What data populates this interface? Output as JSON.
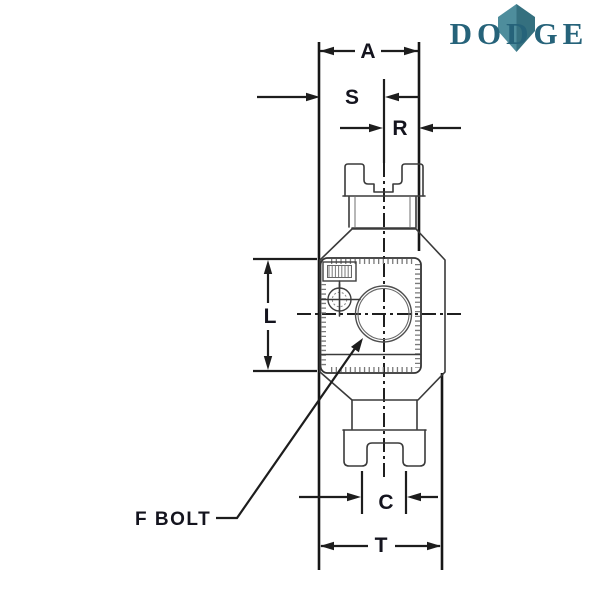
{
  "logo": {
    "text": "DODGE",
    "text_color": "#26637a",
    "gem_left_color": "#4e8d9c",
    "gem_right_color": "#35707f"
  },
  "labels": {
    "a": "A",
    "s": "S",
    "r": "R",
    "l": "L",
    "c": "C",
    "t": "T",
    "f_bolt": "F BOLT"
  },
  "drawing": {
    "line_color": "#1d1d1d",
    "outline_color": "#3a3a3a",
    "background_color": "#ffffff"
  }
}
